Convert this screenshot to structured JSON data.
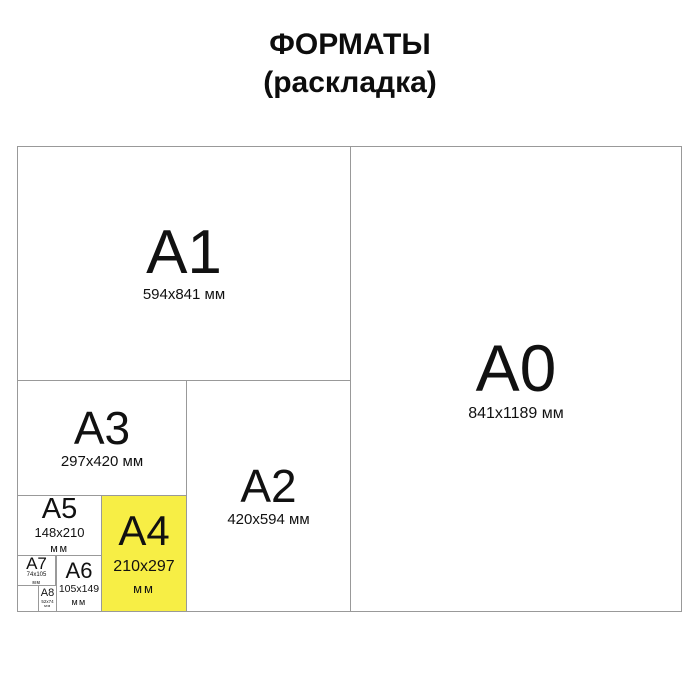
{
  "title": {
    "line1": "ФОРМАТЫ",
    "line2": "(раскладка)"
  },
  "colors": {
    "background": "#ffffff",
    "border": "#999999",
    "text": "#111111",
    "highlight": "#f7ee45"
  },
  "formats": {
    "a0": {
      "label": "A0",
      "dims": "841x1189 мм"
    },
    "a1": {
      "label": "A1",
      "dims": "594x841 мм"
    },
    "a2": {
      "label": "A2",
      "dims": "420x594 мм"
    },
    "a3": {
      "label": "A3",
      "dims": "297x420 мм"
    },
    "a4": {
      "label": "A4",
      "dims": "210x297",
      "unit": "мм",
      "highlighted": true
    },
    "a5": {
      "label": "A5",
      "dims": "148x210",
      "unit": "мм"
    },
    "a6": {
      "label": "A6",
      "dims": "105x149",
      "unit": "мм"
    },
    "a7": {
      "label": "A7",
      "dims": "74x105",
      "unit": "мм"
    },
    "a8": {
      "label": "A8",
      "dims": "52x74",
      "unit": "мм"
    }
  }
}
